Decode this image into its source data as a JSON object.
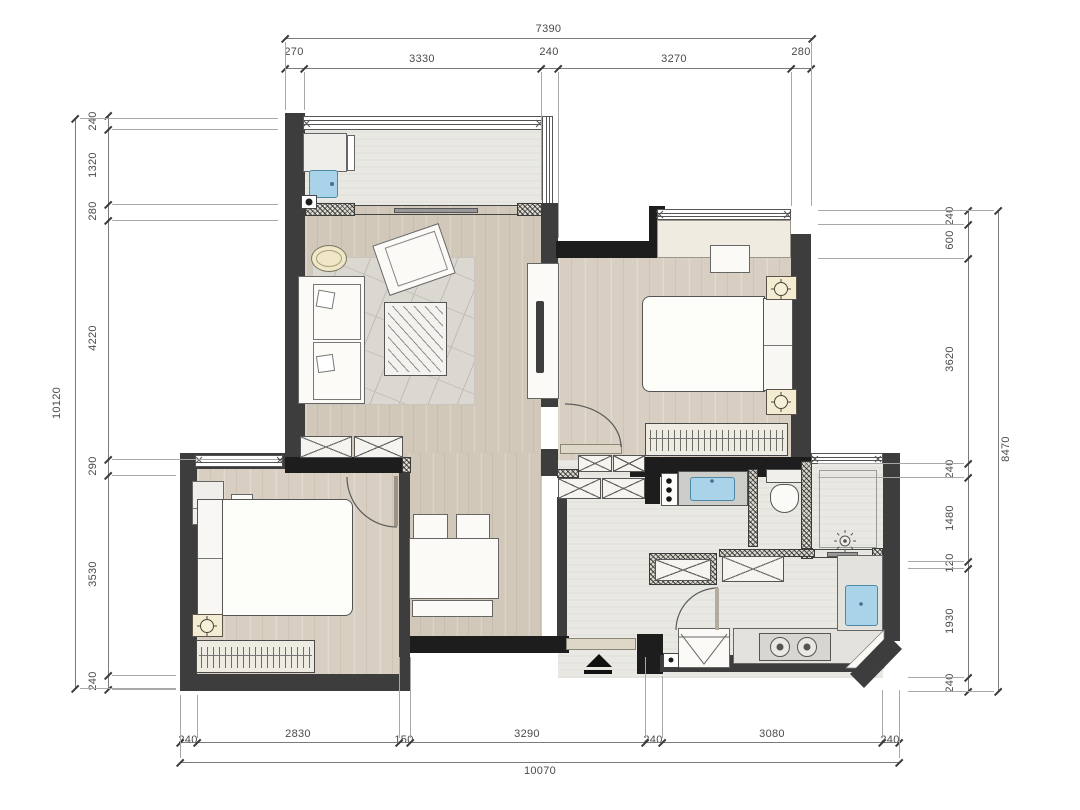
{
  "dimensions": {
    "top": {
      "total": "7390",
      "segments": [
        "270",
        "3330",
        "240",
        "3270",
        "280"
      ]
    },
    "left": {
      "total": "10120",
      "segments": [
        "240",
        "1320",
        "280",
        "4220",
        "290",
        "3530",
        "240"
      ]
    },
    "right": {
      "total": "8470",
      "segments": [
        "240",
        "600",
        "3620",
        "240",
        "1480",
        "120",
        "1930",
        "240"
      ]
    },
    "bottom": {
      "total": "10070",
      "segments": [
        "240",
        "2830",
        "150",
        "3290",
        "240",
        "3080",
        "240"
      ]
    }
  },
  "colors": {
    "wall": "#3d3d3d",
    "wall_dark": "#1d1d1d",
    "wood_floor": "#d2c8b9",
    "wood_floor_light": "#d8cfc2",
    "tile_floor": "#e9e8e3",
    "appliance_blue": "#a9d3e8",
    "nightstand_beige": "#f3ecd2",
    "dimension_text": "#4a4a4a"
  },
  "symbols": {
    "entrance_arrow": "filled-triangle-with-bar",
    "ceiling_lamp": "circle-with-cross",
    "floor_drain": "rayed-circle",
    "wardrobe_fill": "hanger-stripes",
    "cabinet_fill": "x-cross",
    "glass_table_fill": "diagonal-hatch"
  }
}
